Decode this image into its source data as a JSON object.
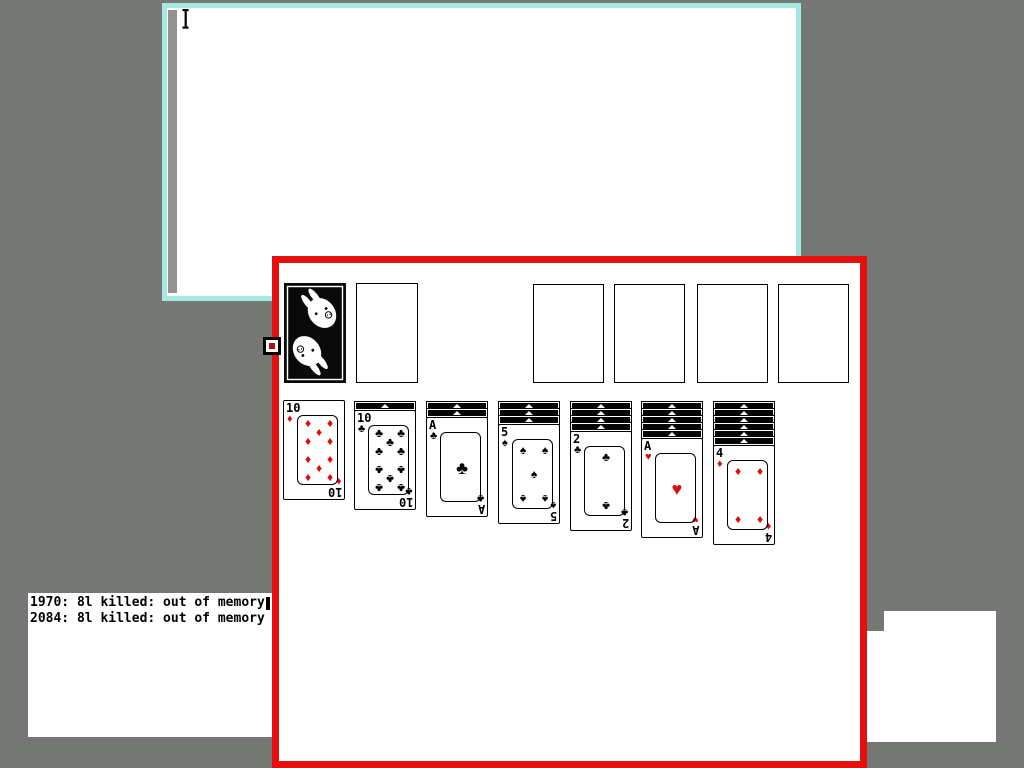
{
  "colors": {
    "desktop": "#747774",
    "cyan_border": "#a5e8e0",
    "red_border": "#e60f0f",
    "red_suit": "#dd0b0b",
    "scrollbar": "#919391",
    "cursor_core": "#b01010"
  },
  "terminal": {
    "lines": [
      "1970: 8l killed: out of memory",
      "2084: 8l killed: out of memory"
    ]
  },
  "solitaire": {
    "stock": {
      "design": "bunny-card-back"
    },
    "waste": {
      "empty": true
    },
    "foundations": [
      {
        "empty": true
      },
      {
        "empty": true
      },
      {
        "empty": true
      },
      {
        "empty": true
      }
    ],
    "tableau": [
      {
        "facedown": 0,
        "faceup": {
          "rank": "10",
          "suit": "diamond"
        }
      },
      {
        "facedown": 1,
        "faceup": {
          "rank": "10",
          "suit": "club"
        }
      },
      {
        "facedown": 2,
        "faceup": {
          "rank": "A",
          "suit": "club"
        }
      },
      {
        "facedown": 3,
        "faceup": {
          "rank": "5",
          "suit": "spade"
        }
      },
      {
        "facedown": 4,
        "faceup": {
          "rank": "2",
          "suit": "club"
        }
      },
      {
        "facedown": 5,
        "faceup": {
          "rank": "A",
          "suit": "heart"
        }
      },
      {
        "facedown": 6,
        "faceup": {
          "rank": "4",
          "suit": "diamond"
        }
      }
    ]
  }
}
